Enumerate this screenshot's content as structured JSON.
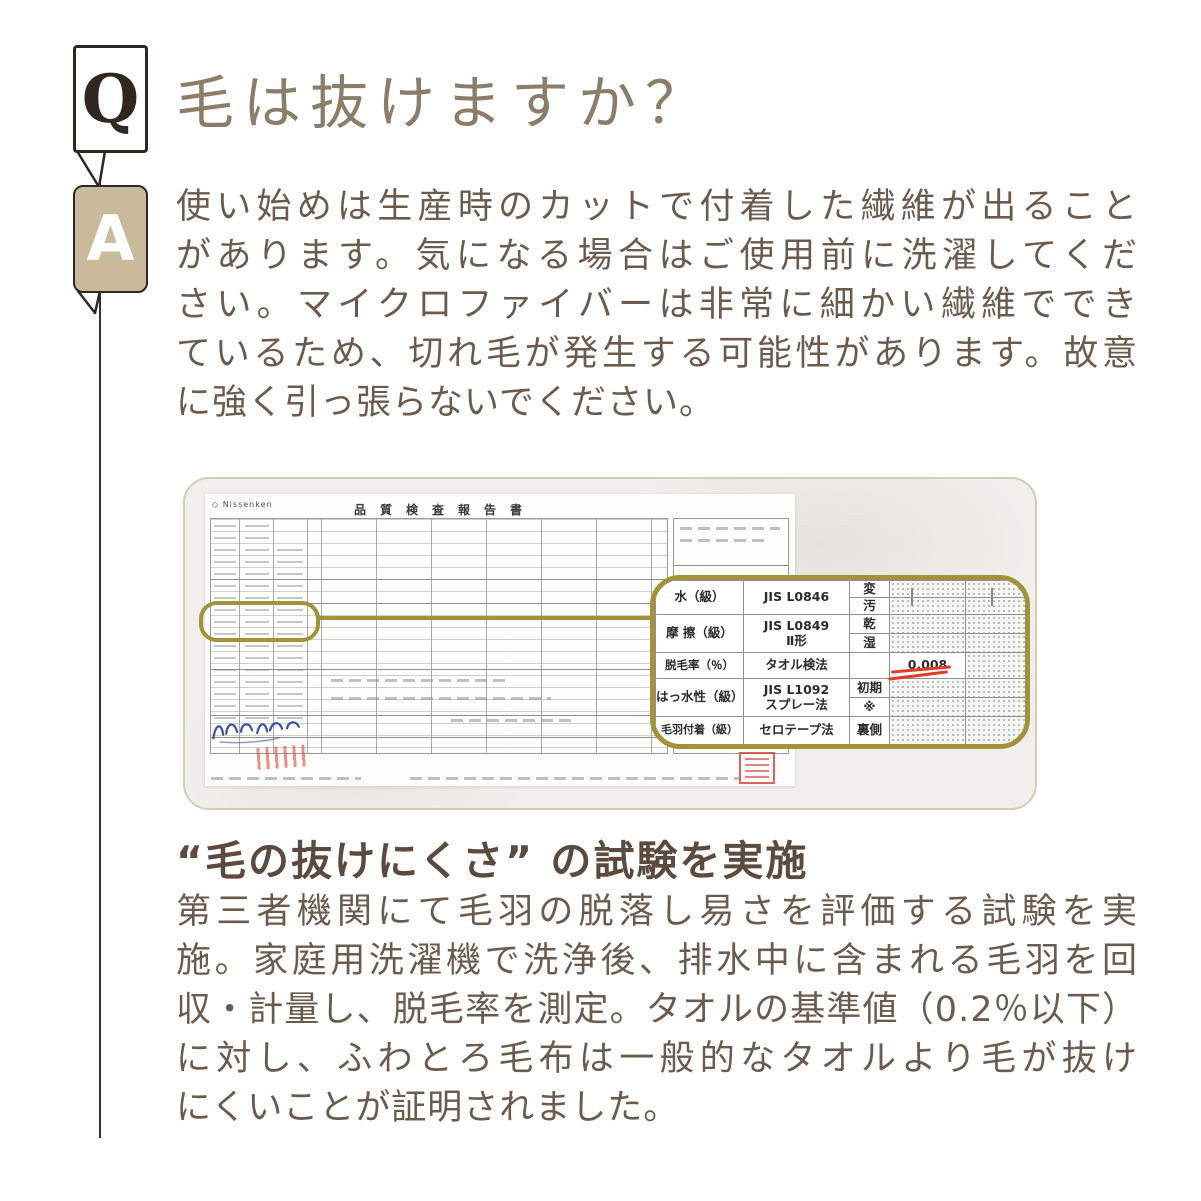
{
  "qa": {
    "q_label": "Q",
    "a_label": "A",
    "question": "毛は抜けますか？",
    "answer_lines": [
      "使い始めは生産時のカットで付着した繊維が出ること",
      "があります。気になる場合はご使用前に洗濯してくだ",
      "さい。マイクロファイバーは非常に細かい繊維ででき",
      "ているため、切れ毛が発生する可能性があります。故意",
      "に強く引っ張らないでください。"
    ]
  },
  "figure": {
    "report": {
      "logo_text": "◇ Nissenken",
      "title": "品質検査報告書"
    },
    "callout": {
      "rows": [
        {
          "item": "水（級）",
          "method": "JIS L0846",
          "sub1": "変",
          "sub2": "汚"
        },
        {
          "item": "摩 擦（級）",
          "method1": "JIS L0849",
          "method2": "Ⅱ形",
          "sub1": "乾",
          "sub2": "湿"
        },
        {
          "item": "脱毛率（％）",
          "method": "タオル検法",
          "value": "0.008"
        },
        {
          "item": "はっ水性（級）",
          "method1": "JIS L1092",
          "method2": "スプレー法",
          "sub1": "初期",
          "sub2": "※"
        },
        {
          "item": "毛羽付着（級）",
          "method": "セロテープ法",
          "sub1": "裏側"
        }
      ],
      "highlight_color": "#a2923c",
      "underline_color": "#e23b2c",
      "test_value": "0.008"
    }
  },
  "result": {
    "heading": "“毛の抜けにくさ” の試験を実施",
    "body_lines": [
      "第三者機関にて毛羽の脱落し易さを評価する試験を実",
      "施。家庭用洗濯機で洗浄後、排水中に含まれる毛羽を回",
      "収・計量し、脱毛率を測定。タオルの基準値（0.2％以下）",
      "に対し、ふわとろ毛布は一般的なタオルより毛が抜け",
      "にくいことが証明されました。"
    ]
  },
  "colors": {
    "accent_gold": "#a2923c",
    "badge_tan": "#c8ba9a",
    "ink_dark": "#2f2720",
    "text_brown": "#6c5b4d",
    "title_brown": "#8b7d68",
    "heading_brown": "#5d4a3e",
    "stamp_red": "#d84a3c"
  }
}
